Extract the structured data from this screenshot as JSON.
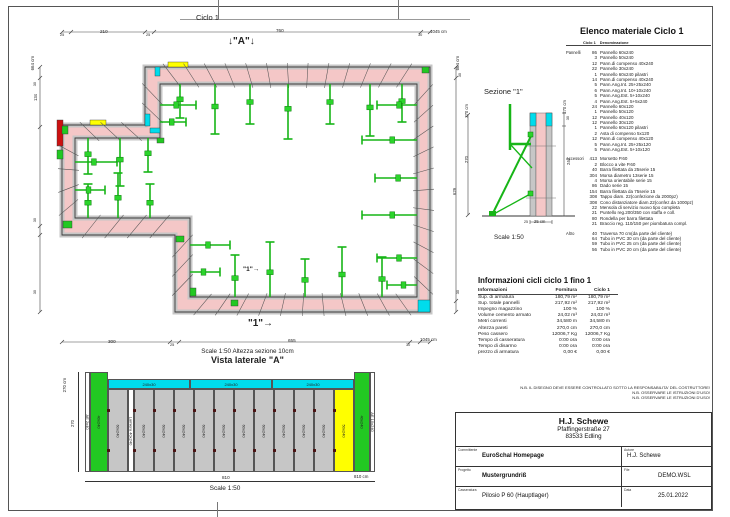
{
  "colors": {
    "wall": "#f4c7c7",
    "formwork": "#c6c6c6",
    "outline": "#3a3a3a",
    "green": "#17b517",
    "yellow": "#ffff00",
    "cyan": "#00dcec",
    "red": "#cc1111"
  },
  "plan": {
    "title": "Ciclo 1",
    "marker_a": "↓\"A\"↓",
    "marker_1": "\"1\"",
    "arrow": "→",
    "scale_note": "Scale 1:50   Altezza sezione 10cm",
    "dims": {
      "top": [
        "25",
        "210",
        "25",
        "760",
        "30",
        "1045 cm"
      ],
      "bottom": [
        "300",
        "25",
        "655",
        "30",
        "1045 cm"
      ],
      "left": [
        "664 cm",
        "30",
        "134",
        "30",
        "30"
      ],
      "right": [
        "664 cm",
        "30",
        "270 cm",
        "270",
        "629",
        "30"
      ]
    },
    "geometry": {
      "outer": [
        [
          115,
          57
        ],
        [
          400,
          57
        ],
        [
          400,
          302
        ],
        [
          145,
          302
        ],
        [
          145,
          225
        ],
        [
          32,
          225
        ],
        [
          32,
          115
        ],
        [
          115,
          115
        ]
      ],
      "inner": [
        [
          130,
          74
        ],
        [
          387,
          74
        ],
        [
          387,
          287
        ],
        [
          160,
          287
        ],
        [
          160,
          208
        ],
        [
          45,
          208
        ],
        [
          45,
          128
        ],
        [
          130,
          128
        ]
      ],
      "accents": [
        {
          "x": 138,
          "y": 52,
          "w": 20,
          "h": 5,
          "c": "#ffff00"
        },
        {
          "x": 60,
          "y": 110,
          "w": 16,
          "h": 5,
          "c": "#ffff00"
        },
        {
          "x": 27,
          "y": 110,
          "w": 6,
          "h": 26,
          "c": "#cc1111"
        },
        {
          "x": 115,
          "y": 104,
          "w": 5,
          "h": 12,
          "c": "#00dcec"
        },
        {
          "x": 120,
          "y": 118,
          "w": 10,
          "h": 5,
          "c": "#00dcec"
        },
        {
          "x": 388,
          "y": 290,
          "w": 12,
          "h": 12,
          "c": "#00dcec"
        },
        {
          "x": 125,
          "y": 57,
          "w": 5,
          "h": 9,
          "c": "#00dcec"
        },
        {
          "x": 33,
          "y": 211,
          "w": 9,
          "h": 7,
          "c": "#22c822"
        },
        {
          "x": 146,
          "y": 226,
          "w": 8,
          "h": 6,
          "c": "#22c822"
        },
        {
          "x": 160,
          "y": 278,
          "w": 6,
          "h": 8,
          "c": "#22c822"
        },
        {
          "x": 127,
          "y": 128,
          "w": 7,
          "h": 5,
          "c": "#22c822"
        },
        {
          "x": 392,
          "y": 57,
          "w": 7,
          "h": 6,
          "c": "#22c822"
        },
        {
          "x": 32,
          "y": 116,
          "w": 6,
          "h": 8,
          "c": "#22c822"
        },
        {
          "x": 27,
          "y": 140,
          "w": 6,
          "h": 9,
          "c": "#22c822"
        },
        {
          "x": 201,
          "y": 290,
          "w": 7,
          "h": 6,
          "c": "#22c822"
        }
      ],
      "ties": [
        [
          150,
          74,
          "s",
          34
        ],
        [
          185,
          74,
          "s",
          50
        ],
        [
          220,
          74,
          "s",
          40
        ],
        [
          258,
          74,
          "s",
          55
        ],
        [
          300,
          74,
          "s",
          40
        ],
        [
          340,
          74,
          "s",
          52
        ],
        [
          372,
          74,
          "s",
          38
        ],
        [
          387,
          95,
          "w",
          40
        ],
        [
          387,
          130,
          "w",
          55
        ],
        [
          387,
          168,
          "w",
          42
        ],
        [
          387,
          205,
          "w",
          55
        ],
        [
          387,
          248,
          "w",
          40
        ],
        [
          387,
          275,
          "w",
          30
        ],
        [
          205,
          287,
          "n",
          42
        ],
        [
          240,
          287,
          "n",
          55
        ],
        [
          275,
          287,
          "n",
          38
        ],
        [
          312,
          287,
          "n",
          50
        ],
        [
          352,
          287,
          "n",
          40
        ],
        [
          160,
          235,
          "e",
          40
        ],
        [
          160,
          262,
          "e",
          30
        ],
        [
          58,
          208,
          "n",
          34
        ],
        [
          88,
          208,
          "n",
          45
        ],
        [
          120,
          208,
          "n",
          34
        ],
        [
          45,
          152,
          "e",
          42
        ],
        [
          45,
          180,
          "e",
          30
        ],
        [
          58,
          128,
          "s",
          36
        ],
        [
          90,
          128,
          "s",
          48
        ],
        [
          118,
          128,
          "s",
          34
        ],
        [
          130,
          95,
          "e",
          36
        ],
        [
          130,
          112,
          "e",
          26
        ]
      ]
    }
  },
  "sezione": {
    "title": "Sezione \"1\"",
    "scale": "Scale 1:50",
    "dim_total": "270 cm",
    "dim_top": "30",
    "dim_bottom": "240",
    "dim_width_tick": "25",
    "dim_width": "25 cm"
  },
  "elenco": {
    "title": "Elenco materiale  Ciclo 1",
    "col_qty": "Ciclo 1",
    "col_name": "Denominazione",
    "groups": [
      {
        "label": "Pannelli",
        "items": [
          [
            "86",
            "Pannello 60x240"
          ],
          [
            "3",
            "Pannello 50x240"
          ],
          [
            "12",
            "Pann.di compenso 40x240"
          ],
          [
            "22",
            "Pannello 30x240"
          ],
          [
            "1",
            "Pannello 60x240 pilastri"
          ],
          [
            "14",
            "Pann.di compenso 40x240"
          ],
          [
            "5",
            "Pann.Ang.Int. 25+25x240"
          ],
          [
            "6",
            "Pann.Ang.Int. 10+10x240"
          ],
          [
            "5",
            "Pann.Ang.Est. 5+10x240"
          ],
          [
            "4",
            "Pann.Ang.Est. 5+5x240"
          ],
          [
            "24",
            "Pannello 60x120"
          ],
          [
            "1",
            "Pannello 50x120"
          ],
          [
            "12",
            "Pannello 40x120"
          ],
          [
            "12",
            "Pannello 30x120"
          ],
          [
            "1",
            "Pannello 60x120 pilastri"
          ],
          [
            "2",
            "Asta di compenso 5x120"
          ],
          [
            "12",
            "Pann.di compenso 40x120"
          ],
          [
            "5",
            "Pann.Ang.Int. 25+25x120"
          ],
          [
            "5",
            "Pann.Ang.Est. 5+10x120"
          ]
        ]
      },
      {
        "label": "Accessori",
        "items": [
          [
            "413",
            "Morsetto P.60"
          ],
          [
            "2",
            "Blocco a vite P.60"
          ],
          [
            "40",
            "Barra filettata da 25serie 15"
          ],
          [
            "304",
            "Morsa diametro 13serie 15"
          ],
          [
            "4",
            "Morsa orientabile serie 15"
          ],
          [
            "86",
            "Dado serie 15"
          ],
          [
            "154",
            "Barra filettata da 75serie 15"
          ],
          [
            "308",
            "Tappo diam. 22(confezione da 2000pz)"
          ],
          [
            "308",
            "Cono distanziatore diam.22(confez.da 1000pz)"
          ],
          [
            "22",
            "Mensola di servizio nuovo tipo completa"
          ],
          [
            "21",
            "Puntello reg.200/350 con staffa e coll."
          ],
          [
            "80",
            "Rondella per barra filettata"
          ],
          [
            "21",
            "Braccio reg. 110/150 per piombatura compl."
          ]
        ]
      },
      {
        "label": "Altro",
        "items": [
          [
            "40",
            "Traversa 70 cm(da parte del cliente)"
          ],
          [
            "64",
            "Tubo in PVC 30 cm (da parte del cliente)"
          ],
          [
            "59",
            "Tubo in PVC 25 cm (da parte del cliente)"
          ],
          [
            "56",
            "Tubo in PVC 20 cm (da parte del cliente)"
          ]
        ]
      }
    ]
  },
  "info": {
    "title": "Informazioni cicli  ciclo 1 fino 1",
    "headers": [
      "Informazioni",
      "Fornitura",
      "Ciclo 1"
    ],
    "rows": [
      [
        "Sup. di armatura",
        "180,79 m²",
        "180,79 m²"
      ],
      [
        "Sup. totale pannelli",
        "217,92 m²",
        "217,92 m²"
      ],
      [
        "Impegno magazzino",
        "100 %",
        "100 %"
      ],
      [
        "Volume cemento armato",
        "24,02 m³",
        "24,02 m³"
      ],
      [
        "Metri correnti",
        "34,580 m",
        "34,580 m"
      ],
      [
        "Altezza pareti",
        "270,0 cm",
        "270,0 cm"
      ],
      [
        "Peso cassero",
        "12006,7 Kg",
        "12006,7 Kg"
      ],
      [
        "Tempo di casseratura",
        "0:00 ora",
        "0:00 ora"
      ],
      [
        "Tempo di disarmo",
        "0:00 ora",
        "0:00 ora"
      ],
      [
        "prezzo di armatura",
        "0,00 €",
        "0,00 €"
      ]
    ]
  },
  "vista": {
    "title": "Vista laterale \"A\"",
    "scale": "Scale 1:50",
    "dim_left_total": "270 cm",
    "dim_left": "270",
    "dim_bottom": "810",
    "dim_bottom_total": "810 cm",
    "cyan_labels": [
      "240x30",
      "240x30",
      "240x30"
    ],
    "panels": [
      {
        "w": 5,
        "t": "ae",
        "label": "AE 2x40"
      },
      {
        "w": 18,
        "t": "green",
        "label": "40x240"
      },
      {
        "w": 20,
        "t": "gray",
        "label": "60x240"
      },
      {
        "w": 6,
        "t": "lamiera",
        "label": "Lamiera 40x240"
      },
      {
        "w": 20,
        "t": "gray",
        "label": "60x240"
      },
      {
        "w": 20,
        "t": "gray",
        "label": "60x240"
      },
      {
        "w": 20,
        "t": "gray",
        "label": "60x240"
      },
      {
        "w": 20,
        "t": "gray",
        "label": "60x240"
      },
      {
        "w": 20,
        "t": "gray",
        "label": "60x240"
      },
      {
        "w": 20,
        "t": "gray",
        "label": "60x240"
      },
      {
        "w": 20,
        "t": "gray",
        "label": "60x240"
      },
      {
        "w": 20,
        "t": "gray",
        "label": "60x240"
      },
      {
        "w": 20,
        "t": "gray",
        "label": "60x240"
      },
      {
        "w": 20,
        "t": "gray",
        "label": "60x240"
      },
      {
        "w": 20,
        "t": "yellow",
        "label": "50x240"
      },
      {
        "w": 16,
        "t": "green",
        "label": "40x240"
      },
      {
        "w": 5,
        "t": "ae",
        "label": "AE 10x240"
      }
    ]
  },
  "notes": [
    "N.B. IL DISEGNO DEVE ESSERE CONTROLLATO SOTTO LA RESPONSABILITA' DEL COSTRUTTORE!",
    "N.B. OSSERVARE LE ISTRUZIONI D'USO!",
    "N.B. OSSERVARE LE ISTRUZIONI D'USO!"
  ],
  "titleblock": {
    "company": "H.J. Schewe",
    "address1": "Pfaffingerstraße 27",
    "address2": "83533 Edling",
    "fields": [
      {
        "label": "Committente",
        "value": "EuroSchal Homepage"
      },
      {
        "label": "Autore",
        "value": "H.J. Schewe"
      },
      {
        "label": "Progetto",
        "value": "Mustergrundriß"
      },
      {
        "label": "File",
        "value": "DEMO.WSL"
      },
      {
        "label": "Casseratura",
        "value": "Pilosio P 60 (Hauptlager)"
      },
      {
        "label": "Data",
        "value": "25.01.2022"
      }
    ]
  }
}
